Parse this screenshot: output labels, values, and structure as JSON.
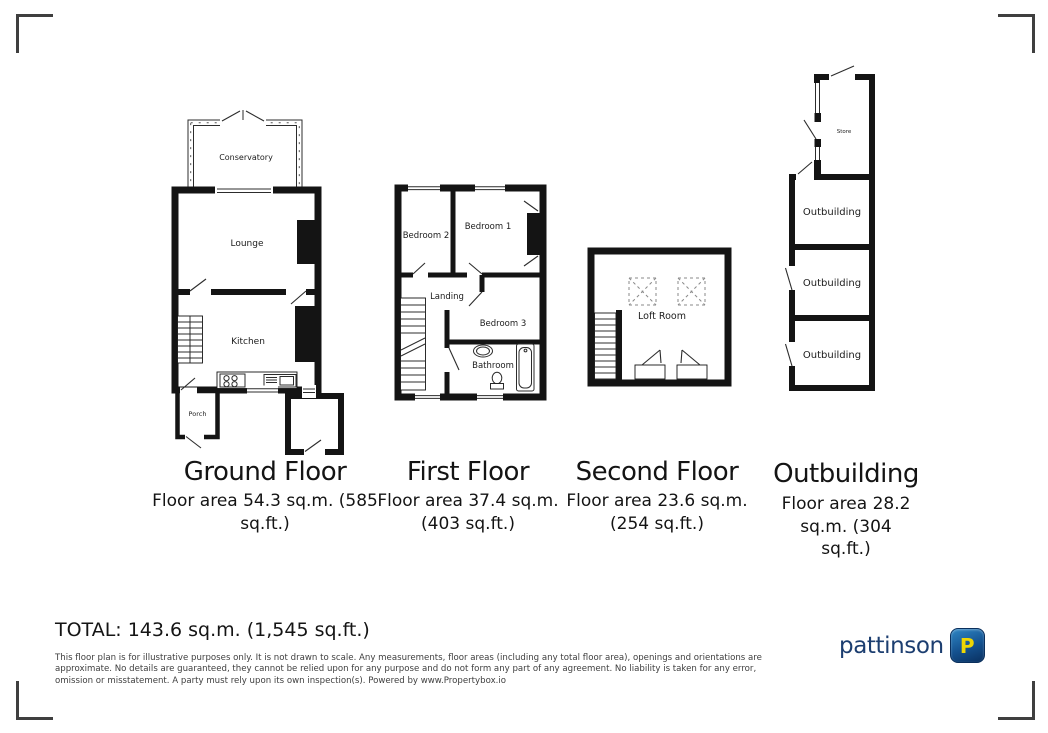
{
  "plans": {
    "ground": {
      "title": "Ground Floor",
      "area_lines": [
        "Floor area 54.3 sq.m. (585",
        "sq.ft.)"
      ],
      "rooms": {
        "conservatory": "Conservatory",
        "lounge": "Lounge",
        "kitchen": "Kitchen",
        "porch": "Porch"
      }
    },
    "first": {
      "title": "First Floor",
      "area_lines": [
        "Floor area 37.4 sq.m.",
        "(403 sq.ft.)"
      ],
      "rooms": {
        "bedroom2": "Bedroom 2",
        "bedroom1": "Bedroom 1",
        "landing": "Landing",
        "bedroom3": "Bedroom 3",
        "bathroom": "Bathroom"
      }
    },
    "second": {
      "title": "Second Floor",
      "area_lines": [
        "Floor area 23.6 sq.m.",
        "(254 sq.ft.)"
      ],
      "rooms": {
        "loft": "Loft Room"
      }
    },
    "outbuilding": {
      "title": "Outbuilding",
      "area_lines": [
        "Floor area 28.2",
        "sq.m. (304",
        "sq.ft.)"
      ],
      "rooms": {
        "store": "Store",
        "unit1": "Outbuilding",
        "unit2": "Outbuilding",
        "unit3": "Outbuilding"
      }
    }
  },
  "summary": {
    "total": "TOTAL: 143.6 sq.m. (1,545 sq.ft.)"
  },
  "disclaimer": "This floor plan is for illustrative purposes only. It is not drawn to scale. Any measurements, floor areas (including any total floor area), openings and orientations are approximate. No details are guaranteed, they cannot be relied upon for any purpose and do not form any part of any agreement. No liability is taken for any error, omission or misstatement. A party must rely upon its own inspection(s). Powered by www.Propertybox.io",
  "logo": {
    "brand": "pattinson",
    "badge_letter": "P",
    "brand_color": "#1c3e70",
    "badge_gradient_top": "#2f87c5",
    "badge_gradient_bottom": "#0a3060",
    "badge_letter_color": "#eed604"
  },
  "colors": {
    "wall": "#141414",
    "corner_marks": "#3f3f3f",
    "disclaimer_text": "#3e3e3e"
  }
}
